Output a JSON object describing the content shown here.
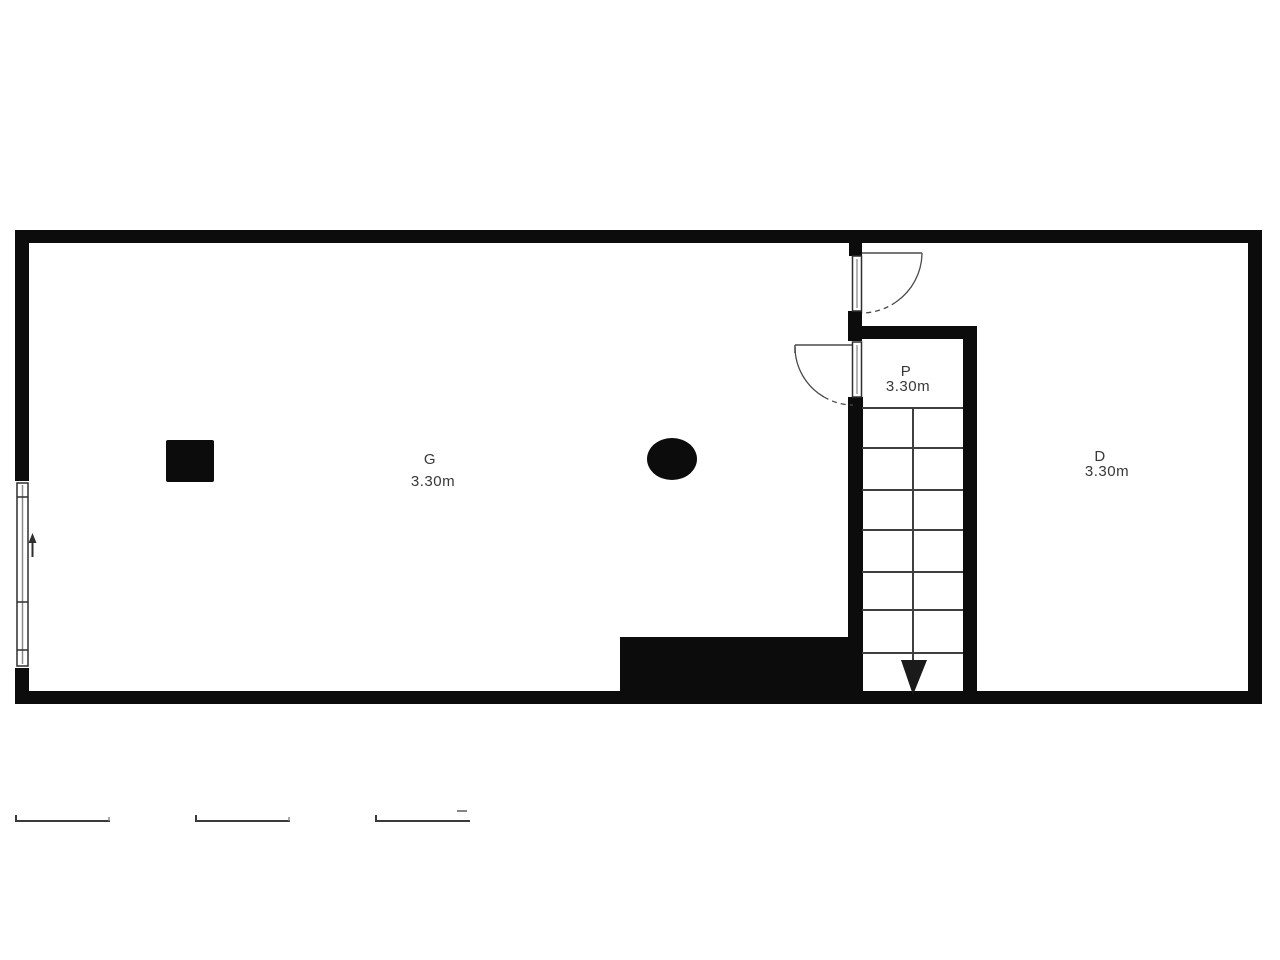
{
  "floorplan": {
    "rooms": [
      {
        "label": "G",
        "dimension": "3.30m"
      },
      {
        "label": "P",
        "dimension": "3.30m"
      },
      {
        "label": "D",
        "dimension": "3.30m"
      }
    ],
    "stairs": {
      "tread_count": 7,
      "direction": "down"
    },
    "colors": {
      "wall": "#0c0c0c",
      "line": "#3f3f3f",
      "text": "#383838",
      "background": "#ffffff"
    }
  }
}
